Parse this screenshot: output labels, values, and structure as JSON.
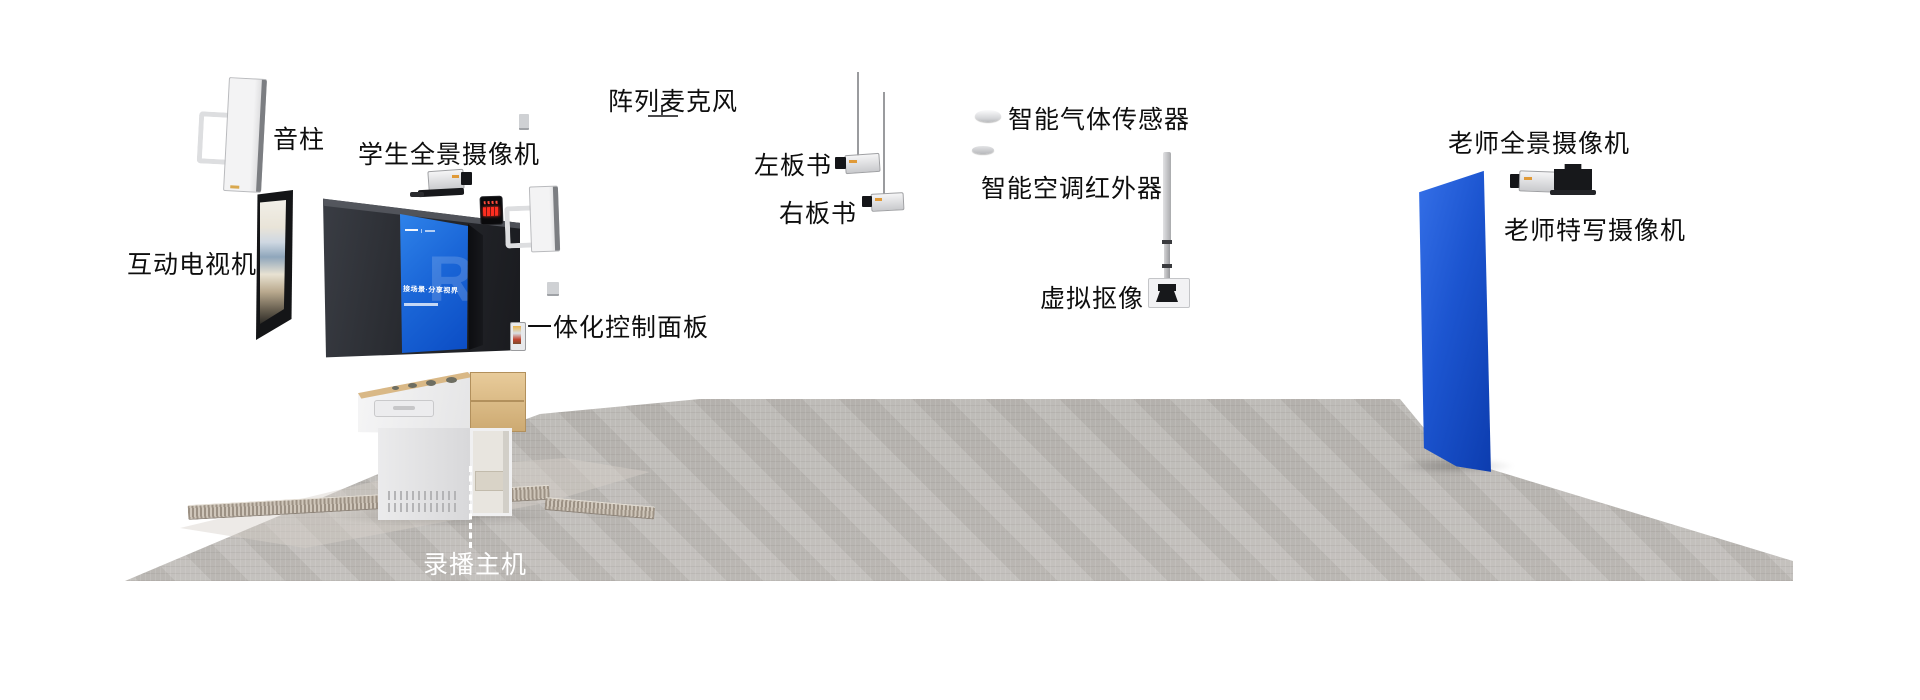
{
  "labels": {
    "sound_column": "音柱",
    "student_panorama_camera": "学生全景摄像机",
    "interactive_tv": "互动电视机",
    "array_microphone": "阵列麦克风",
    "left_board_camera": "左板书",
    "right_board_camera": "右板书",
    "gas_sensor": "智能气体传感器",
    "ac_infrared": "智能空调红外器",
    "virtual_keying": "虚拟抠像",
    "teacher_panorama_camera": "老师全景摄像机",
    "teacher_closeup_camera": "老师特写摄像机",
    "control_panel": "一体化控制面板",
    "recording_host": "录播主机"
  },
  "board_screen": {
    "headline": "接场景·分享视界",
    "watermark": "R"
  },
  "colors": {
    "chroma_screen_blue": "#1c55d0",
    "board_screen_blue": "#1b67d8",
    "label_text": "#0e0e0e",
    "recording_host_text": "#ffffff",
    "carpet_grey": "#b5b2ae",
    "desk_wood": "#ddd0b0",
    "led_red": "#ff2e20"
  }
}
